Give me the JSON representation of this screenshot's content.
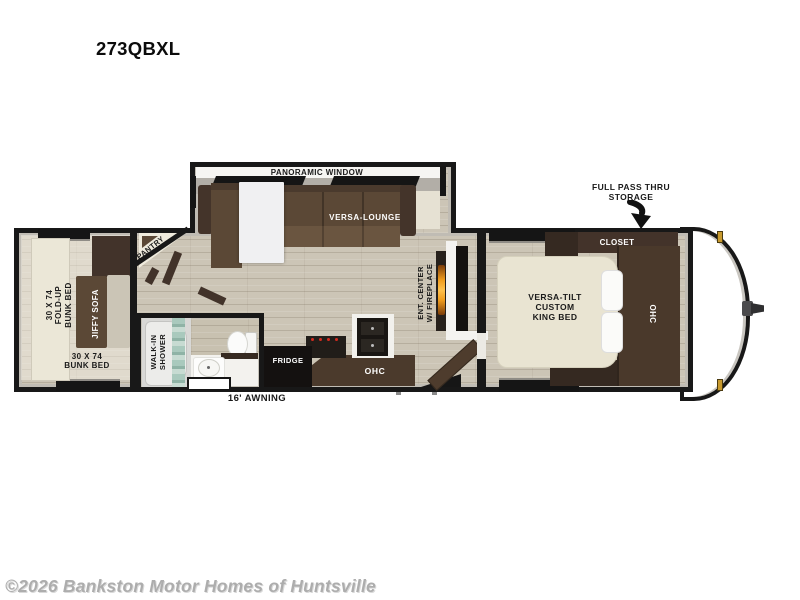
{
  "title": "273QBXL",
  "watermark": "©2026 Bankston Motor Homes of Huntsville",
  "callouts": {
    "storage": "FULL PASS THRU\nSTORAGE",
    "awning": "16' AWNING"
  },
  "slideout": {
    "panoramic_window": "PANORAMIC WINDOW",
    "versa_lounge": "VERSA-LOUNGE"
  },
  "bunk_room": {
    "fold_up_bunk": "30 X 74\nFOLD-UP\nBUNK BED",
    "jiffy_sofa": "JIFFY SOFA",
    "bunk_bed": "30 X 74\nBUNK BED"
  },
  "pantry": "PANTRY",
  "bathroom": {
    "walk_in_shower": "WALK-IN\nSHOWER"
  },
  "kitchen": {
    "fridge": "FRIDGE",
    "ohc": "OHC"
  },
  "living": {
    "ent_center": "ENT. CENTER\nW/ FIREPLACE"
  },
  "bedroom": {
    "closet": "CLOSET",
    "king_bed": "VERSA-TILT\nCUSTOM\nKING BED",
    "ohc": "OHC"
  },
  "colors": {
    "wall": "#181818",
    "floor": "#ccc5b6",
    "cabinet_dark": "#43332a",
    "sofa_brown": "#5b4836",
    "bed_cream": "#e9e4d2",
    "fireplace_glow": "#f09c1d",
    "marker_light": "#c89a2e",
    "watermark_gray": "#adadad"
  }
}
